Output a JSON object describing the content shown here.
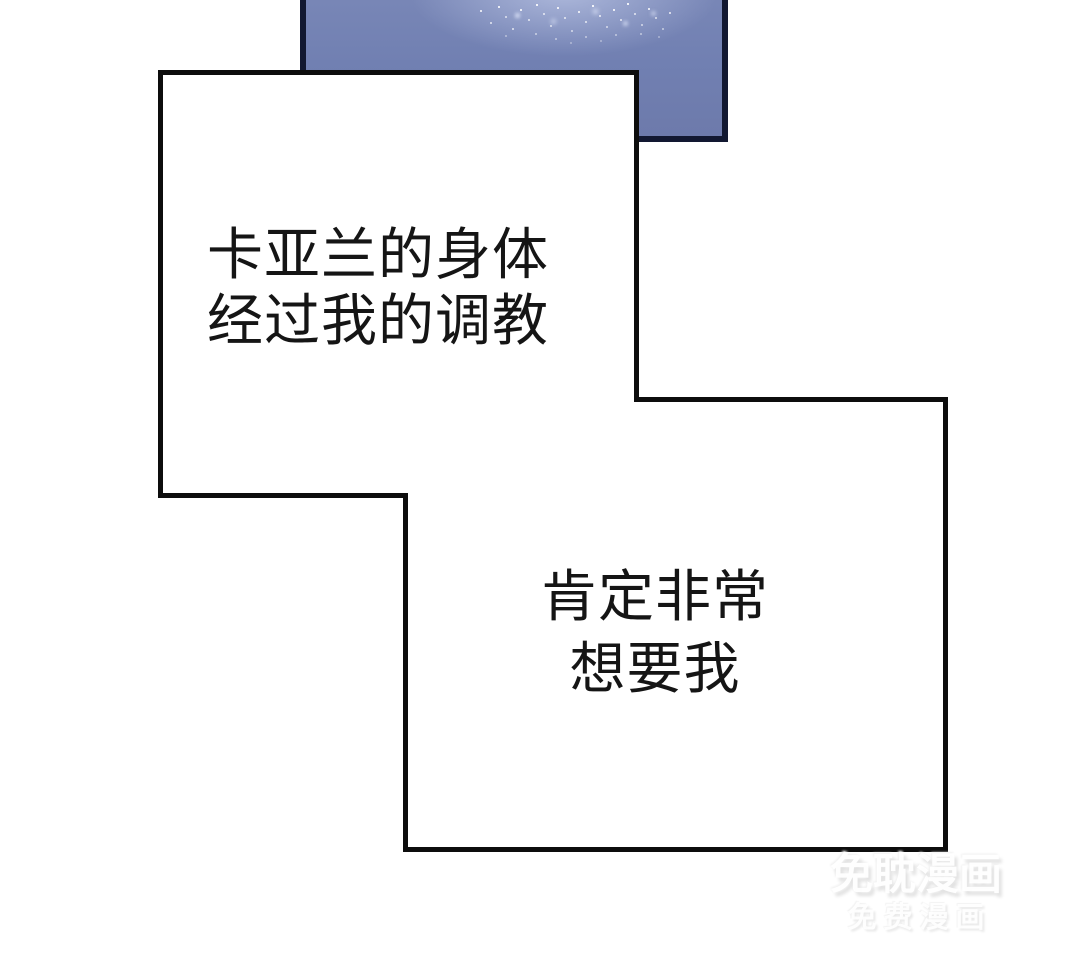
{
  "page": {
    "background_color": "#ffffff",
    "kind": "comic-page"
  },
  "comic_panel": {
    "fill_color": "#7180b2",
    "border_color": "#121831",
    "texture": "white-sparkle-speckles"
  },
  "speech_bubble_1": {
    "border_color": "#0d0d0d",
    "fill_color": "#ffffff",
    "lines": [
      "卡亚兰的身体",
      "经过我的调教"
    ]
  },
  "speech_bubble_2": {
    "border_color": "#0d0d0d",
    "fill_color": "#ffffff",
    "lines": [
      "肯定非常",
      "想要我"
    ]
  },
  "watermark": {
    "title": "免耽漫画",
    "subtitle": "免费漫画"
  }
}
